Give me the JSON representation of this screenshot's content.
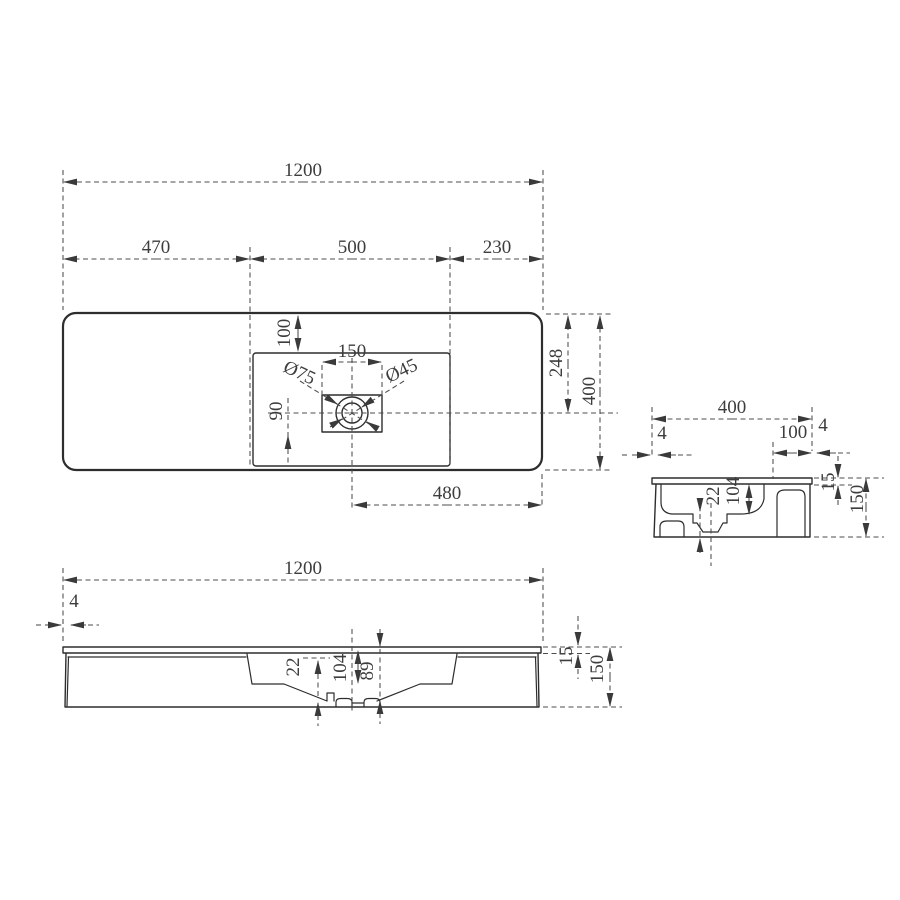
{
  "drawing": {
    "type": "technical-drawing",
    "subject": "Wall-hung rectangular washbasin — dimensioned orthographic views",
    "units": "mm",
    "line_color": "#2d2d2d",
    "dim_color": "#4c4c4c",
    "views": {
      "plan": {
        "name": "top view",
        "dims": {
          "overall_width": "1200",
          "segment_left": "470",
          "segment_center": "500",
          "segment_right": "230",
          "rim_to_basin": "100",
          "faucet_deck_span": "150",
          "drain_outer_dia": "Ø75",
          "drain_inner_dia": "Ø45",
          "drain_offset": "90",
          "rim_to_drain_center": "248",
          "overall_depth": "400",
          "drain_to_right_edge": "480"
        }
      },
      "side": {
        "name": "side section view",
        "dims": {
          "overall_depth": "400",
          "front_lip": "4",
          "rear_deck": "100",
          "rear_lip": "4",
          "rim_thickness": "15",
          "overall_height": "150",
          "sump_step": "22",
          "bowl_depth": "104"
        }
      },
      "front": {
        "name": "front section view",
        "dims": {
          "overall_width": "1200",
          "side_lip": "4",
          "rim_thickness": "15",
          "overall_height": "150",
          "sump_step": "22",
          "bowl_depth": "104",
          "drain_depth": "89"
        }
      }
    }
  }
}
